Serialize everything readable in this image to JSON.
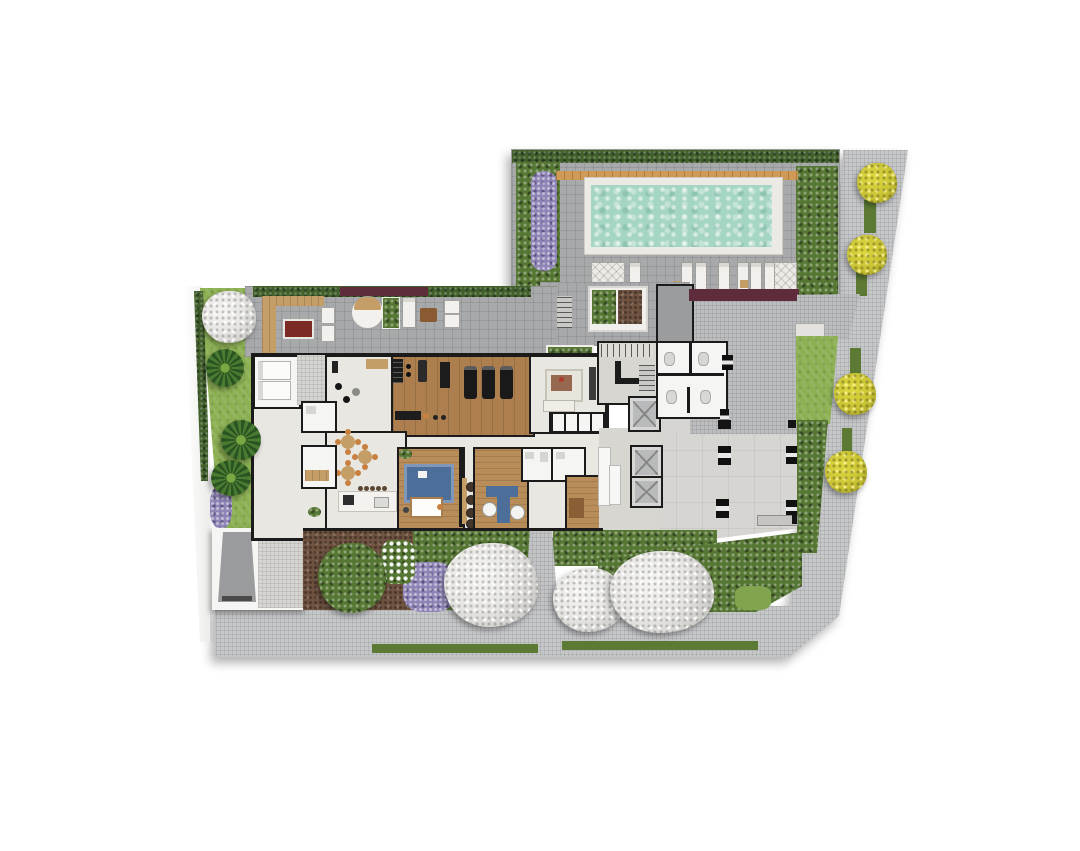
{
  "plan": {
    "type": "residential-ground-floor-site-plan",
    "visible_text": [],
    "areas": {
      "pool_terrace": "pool deck with loungers",
      "roof_terrace": "furnished outdoor terrace",
      "gym": "fitness room",
      "lounge": "lounge with lockers",
      "party_room": "party room with kitchen island",
      "kids_room": "playroom",
      "coworking": "coworking room",
      "core": "stairs and elevators",
      "garage_court": "driveway court and slab",
      "gardens": "perimeter planting"
    }
  },
  "palette": {
    "background": "#ffffff",
    "sidewalk": "#c6c7c9",
    "terrace_paving": "#a7a9ab",
    "driveway": "#bcbdbf",
    "slab": "#d6d5d1",
    "interior": "#e9e7e1",
    "room_white": "#f5f5f3",
    "corridor": "#d8d6d1",
    "wall": "#1b1b1b",
    "wood": "#b98d5a",
    "wood_dark": "#ad7f4e",
    "deck": "#d09a55",
    "pool_water": "#a5d5c3",
    "pool_coping": "#eceae4",
    "hedge": "#42602c",
    "shrub": "#567733",
    "lawn": "#8cb052",
    "verge": "#5d7a35",
    "purple": "#8d83b5",
    "maroon": "#5e2c3b",
    "mulch": "#715441",
    "tree_white": "#e8e7e4",
    "tree_yellow": "#c9c337",
    "palm": "#3a6b2d",
    "ramp": "#9a9b9d",
    "blue": "#4c6e99",
    "orange": "#c7803f",
    "tan": "#c59d66",
    "dark_red": "#7c2a24",
    "equipment": "#222222",
    "elevator": "#b9babc",
    "gray_room": "#9b9c9e"
  }
}
